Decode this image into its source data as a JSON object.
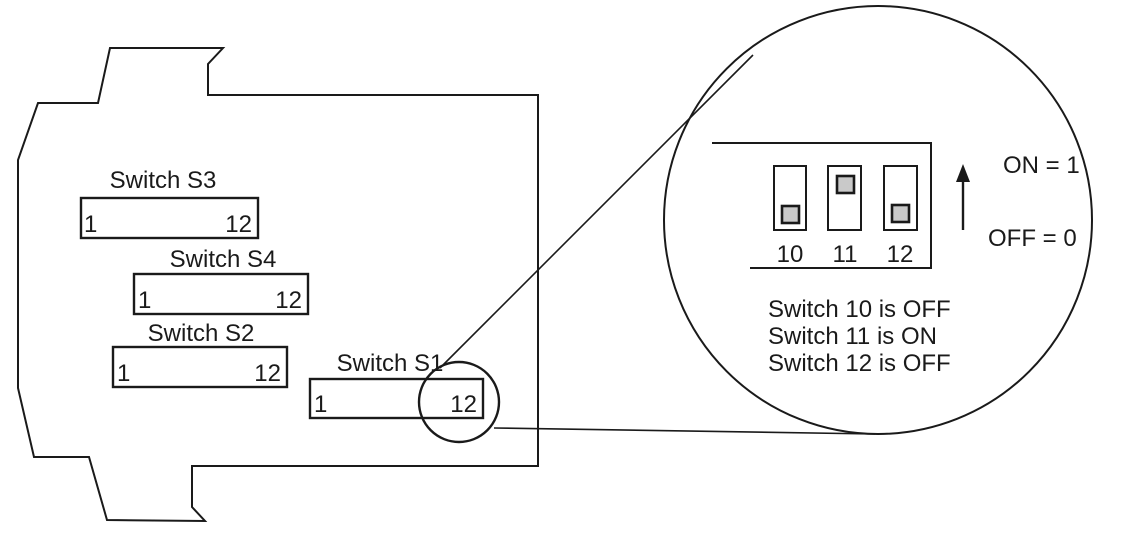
{
  "colors": {
    "ink": "#1a1a1a",
    "knob_fill": "#c9c9c9",
    "background": "#ffffff"
  },
  "device": {
    "switch_blocks": [
      {
        "label": "Switch S3",
        "first": "1",
        "last": "12"
      },
      {
        "label": "Switch S4",
        "first": "1",
        "last": "12"
      },
      {
        "label": "Switch S2",
        "first": "1",
        "last": "12"
      },
      {
        "label": "Switch S1",
        "first": "1",
        "last": "12"
      }
    ]
  },
  "magnifier": {
    "slots": [
      {
        "label": "10",
        "state": "OFF",
        "knob_position": "bottom"
      },
      {
        "label": "11",
        "state": "ON",
        "knob_position": "top"
      },
      {
        "label": "12",
        "state": "OFF",
        "knob_position": "bottom"
      }
    ],
    "legend_on": "ON = 1",
    "legend_off": "OFF = 0",
    "status_lines": [
      "Switch 10 is OFF",
      "Switch 11 is ON",
      "Switch 12 is OFF"
    ]
  }
}
